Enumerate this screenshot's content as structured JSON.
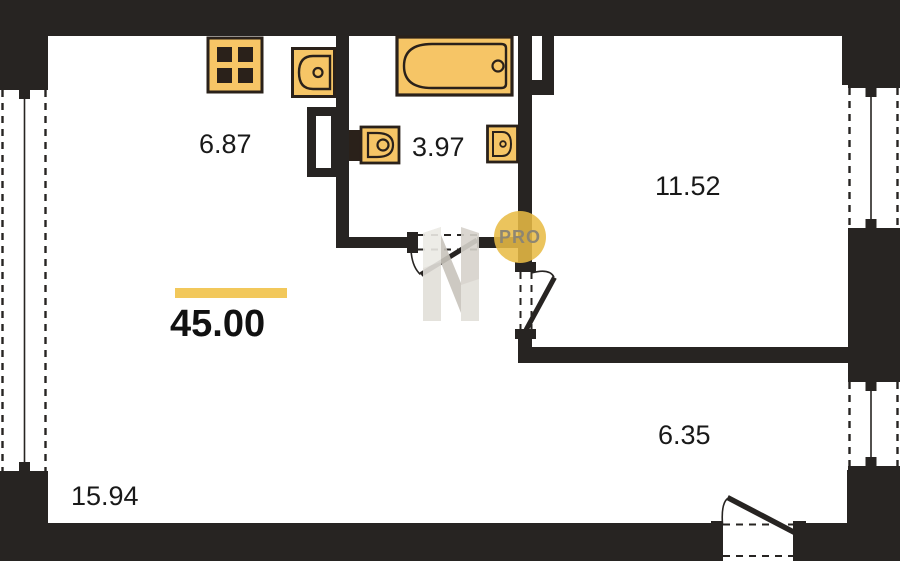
{
  "plan": {
    "title": "apartment-floor-plan",
    "total_area": "45.00",
    "rooms": [
      {
        "name": "kitchen",
        "area": "6.87"
      },
      {
        "name": "bathroom",
        "area": "3.97"
      },
      {
        "name": "bedroom",
        "area": "11.52"
      },
      {
        "name": "hallway",
        "area": "6.35"
      },
      {
        "name": "living-room",
        "area": "15.94"
      }
    ]
  },
  "watermark": {
    "badge": "PRO",
    "logo": "N-monogram"
  },
  "icons": [
    "stove-icon",
    "kitchen-sink-icon",
    "bathtub-icon",
    "toilet-icon",
    "washbasin-icon",
    "vent-shaft-icon",
    "window-icon",
    "door-swing-icon"
  ],
  "colors": {
    "wall": "#272422",
    "fixture_fill": "#F6C566",
    "fixture_stroke": "#2A211A",
    "accent_bar": "#F2C85B",
    "pro_circle": "#E8BB45",
    "pro_text": "#8E8672",
    "watermark_gray": "#D6D2CB"
  }
}
